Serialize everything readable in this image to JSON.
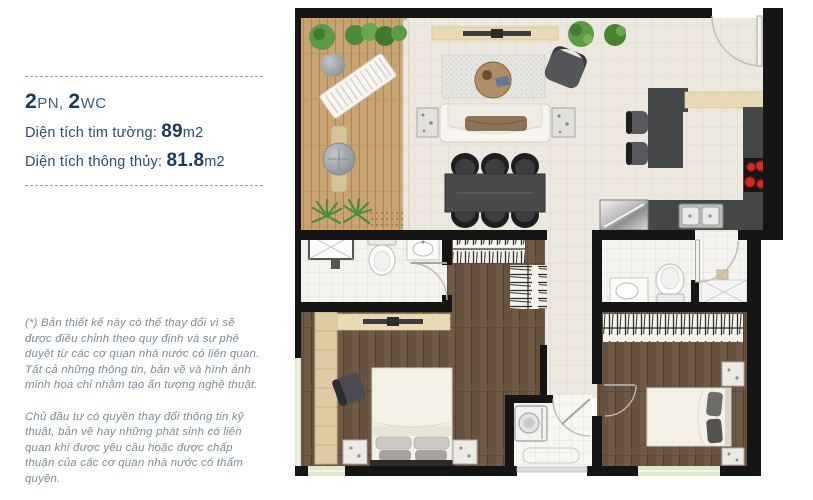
{
  "info_panel": {
    "summary": {
      "bedrooms_value": "2",
      "bedrooms_unit": "PN, ",
      "bathrooms_value": "2",
      "bathrooms_unit": "WC"
    },
    "wall_area": {
      "label": "Diện tích tim tường: ",
      "value": "89",
      "unit": "m2"
    },
    "net_area": {
      "label": "Diện tích thông thủy: ",
      "value": "81.8",
      "unit": "m2"
    },
    "disclaimer": {
      "paragraph_1": "(*) Bản thiết kế này có thể thay đổi vì sẽ được điều chỉnh theo quy định và sự phê duyệt từ các cơ quan nhà nước có liên quan. Tất cả những thông tin, bản vẽ và hình ảnh minh họa chỉ nhằm tạo ấn tượng nghệ thuật.",
      "paragraph_2": "Chủ đầu tư có quyền thay đổi thông tin kỹ thuật, bản vẽ hay những phát sinh có liên quan khi được yêu cầu hoặc được chấp thuận của các cơ quan nhà nước có thẩm quyền."
    }
  },
  "colors": {
    "accent_navy": "#1b3a5c",
    "label_blue": "#2b4d6e",
    "disclaimer_gray": "#7b8b98",
    "wall_black": "#151515",
    "tile_cream": "#ece8e0",
    "deck_wood": "#c9a472",
    "dark_wood": "#6f5947",
    "bath_tile": "#f4f3f0",
    "window_green": "#e0e9cd",
    "stove_red": "#d32b1e",
    "counter_dark": "#454647",
    "console_beige": "#ead9b5"
  }
}
